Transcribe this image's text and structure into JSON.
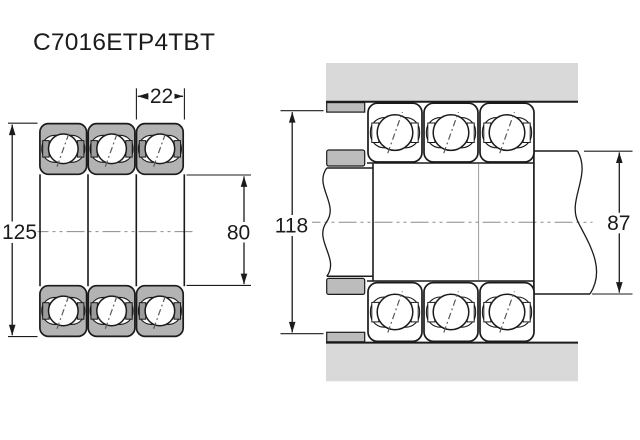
{
  "title": "C7016ETP4TBT",
  "views": {
    "cross_section": {
      "outer_diameter": "125",
      "bore_diameter": "80",
      "ring_width": "22"
    },
    "mounted": {
      "housing_abutment_diameter": "118",
      "shaft_abutment_diameter": "87"
    }
  },
  "colors": {
    "line": "#1b1b1b",
    "ring_fill": "#b3b3b3",
    "cage_fill": "#9c9c9c",
    "housing_fill": "#d9d9d9",
    "spacer_fill": "#bcbcbc",
    "centerline": "#8a8a8a",
    "background": "#ffffff"
  }
}
